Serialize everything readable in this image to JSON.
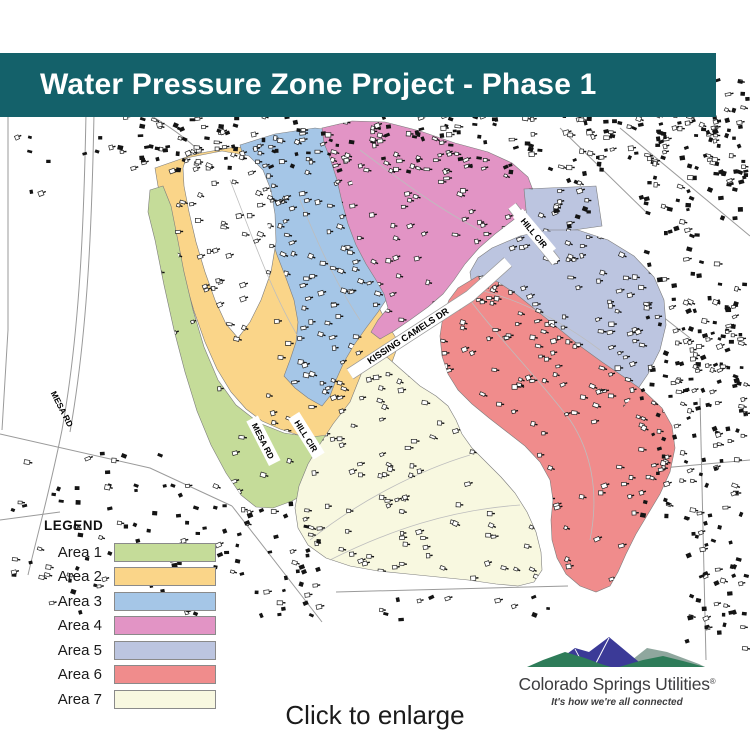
{
  "banner": {
    "title": "Water Pressure Zone Project - Phase 1",
    "bg": "#14616a"
  },
  "areas": [
    {
      "label": "Area 1",
      "color": "#c5dc99"
    },
    {
      "label": "Area 2",
      "color": "#fad589"
    },
    {
      "label": "Area 3",
      "color": "#a5c6e7"
    },
    {
      "label": "Area 4",
      "color": "#e294c5"
    },
    {
      "label": "Area 5",
      "color": "#bcc5e0"
    },
    {
      "label": "Area 6",
      "color": "#f08c8c"
    },
    {
      "label": "Area 7",
      "color": "#f8f8e0"
    }
  ],
  "legend": {
    "title": "LEGEND"
  },
  "streets": {
    "kissing_camels": "KISSING CAMELS DR",
    "mesa_rd": "MESA RD",
    "hill_cir": "HILL CIR"
  },
  "logo": {
    "name": "Colorado Springs Utilities",
    "registered": "®",
    "tagline": "It's how we're all connected",
    "colors": {
      "green": "#2e7c59",
      "blue": "#3b3a97",
      "sage": "#8fa79e"
    }
  },
  "caption": "Click to enlarge"
}
